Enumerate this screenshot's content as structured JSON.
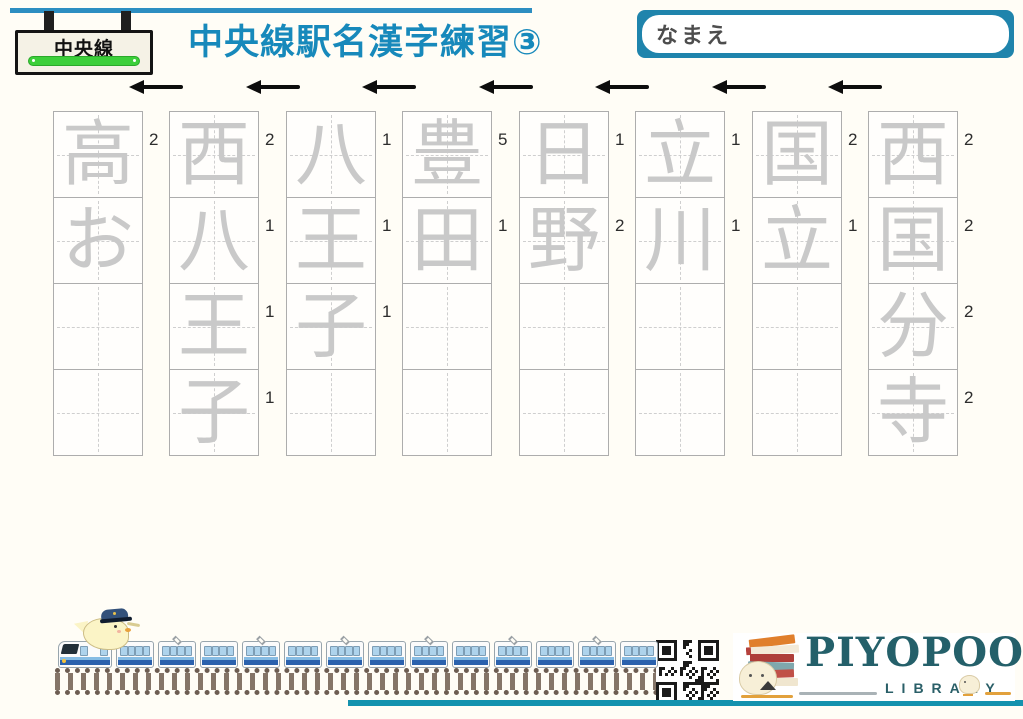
{
  "colors": {
    "accent_blue": "#1789bb",
    "name_box_border": "#1f84ac",
    "sign_green": "#3ccf3a",
    "trace_gray": "#c9c9c9",
    "train_blue": "#2a61ad",
    "logo_teal": "#24606a",
    "logo_orange": "#e2a13c",
    "bottom_line_teal": "#1492ae"
  },
  "header": {
    "sign": {
      "label": "中央線"
    },
    "title": "中央線駅名漢字練習③",
    "name_box": {
      "label": "なまえ"
    }
  },
  "direction_arrows": {
    "count": 7,
    "direction": "left"
  },
  "practice_grid": {
    "rows_per_column": 4,
    "stroke_order_annotations": true,
    "columns": [
      {
        "station": "高お",
        "cells": [
          {
            "char": "高",
            "grade": "2"
          },
          {
            "char": "お",
            "grade": ""
          },
          {
            "char": "",
            "grade": ""
          },
          {
            "char": "",
            "grade": ""
          }
        ]
      },
      {
        "station": "西八王子",
        "cells": [
          {
            "char": "西",
            "grade": "2"
          },
          {
            "char": "八",
            "grade": "1"
          },
          {
            "char": "王",
            "grade": "1"
          },
          {
            "char": "子",
            "grade": "1"
          }
        ]
      },
      {
        "station": "八王子",
        "cells": [
          {
            "char": "八",
            "grade": "1"
          },
          {
            "char": "王",
            "grade": "1"
          },
          {
            "char": "子",
            "grade": "1"
          },
          {
            "char": "",
            "grade": ""
          }
        ]
      },
      {
        "station": "豊田",
        "cells": [
          {
            "char": "豊",
            "grade": "5"
          },
          {
            "char": "田",
            "grade": "1"
          },
          {
            "char": "",
            "grade": ""
          },
          {
            "char": "",
            "grade": ""
          }
        ]
      },
      {
        "station": "日野",
        "cells": [
          {
            "char": "日",
            "grade": "1"
          },
          {
            "char": "野",
            "grade": "2"
          },
          {
            "char": "",
            "grade": ""
          },
          {
            "char": "",
            "grade": ""
          }
        ]
      },
      {
        "station": "立川",
        "cells": [
          {
            "char": "立",
            "grade": "1"
          },
          {
            "char": "川",
            "grade": "1"
          },
          {
            "char": "",
            "grade": ""
          },
          {
            "char": "",
            "grade": ""
          }
        ]
      },
      {
        "station": "国立",
        "cells": [
          {
            "char": "国",
            "grade": "2"
          },
          {
            "char": "立",
            "grade": "1"
          },
          {
            "char": "",
            "grade": ""
          },
          {
            "char": "",
            "grade": ""
          }
        ]
      },
      {
        "station": "西国分寺",
        "cells": [
          {
            "char": "西",
            "grade": "2"
          },
          {
            "char": "国",
            "grade": "2"
          },
          {
            "char": "分",
            "grade": "2"
          },
          {
            "char": "寺",
            "grade": "2"
          }
        ]
      }
    ]
  },
  "footer": {
    "train": {
      "car_count": 14
    },
    "logo": {
      "brand": "PIYOPOO",
      "subtitle": "LIBRARY"
    }
  }
}
